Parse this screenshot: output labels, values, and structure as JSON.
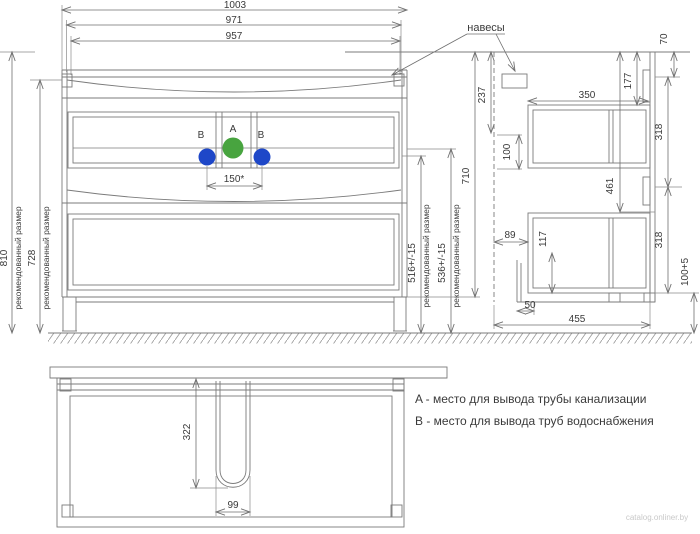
{
  "front_view": {
    "dim_width_total": "1003",
    "dim_width_mid": "971",
    "dim_width_inner": "957",
    "dim_height_recommended_value": "810",
    "dim_height_recommended_note": "рекомендованный размер",
    "dim_height_cabinet_value": "728",
    "dim_height_cabinet_note": "рекомендованный размер",
    "dim_pipe_spacing": "150*",
    "pipe_a_label": "A",
    "pipe_b_left_label": "B",
    "pipe_b_right_label": "B"
  },
  "callout": {
    "hinges_label": "навесы"
  },
  "installation_dims": {
    "water_supply_height_value": "516+/-15",
    "water_supply_height_note": "рекомендованный размер",
    "drain_height_value": "536+/-15",
    "drain_height_note": "рекомендованный размер",
    "total_height": "710"
  },
  "side_view": {
    "dim_bracket_offset": "237",
    "dim_bracket_zone": "100",
    "dim_top_gap": "70",
    "dim_rail_spacing_upper": "318",
    "dim_drawer_depth": "350",
    "dim_top_section": "177",
    "dim_siphon_clearance": "461",
    "dim_front_recess": "89",
    "dim_drawer_height": "117",
    "dim_rail_spacing_lower": "318",
    "dim_leg_height": "100+5",
    "dim_leg_setback": "50",
    "dim_total_depth": "455"
  },
  "bottom_view": {
    "dim_cutout_depth": "322",
    "dim_cutout_width": "99"
  },
  "legend": {
    "line_a": "A - место для вывода трубы канализации",
    "line_b": "B - место для вывода труб водоснабжения"
  },
  "watermark": "catalog.onliner.by",
  "colors": {
    "pipe_a_fill": "#48a43f",
    "pipe_b_fill": "#1e47c8"
  }
}
